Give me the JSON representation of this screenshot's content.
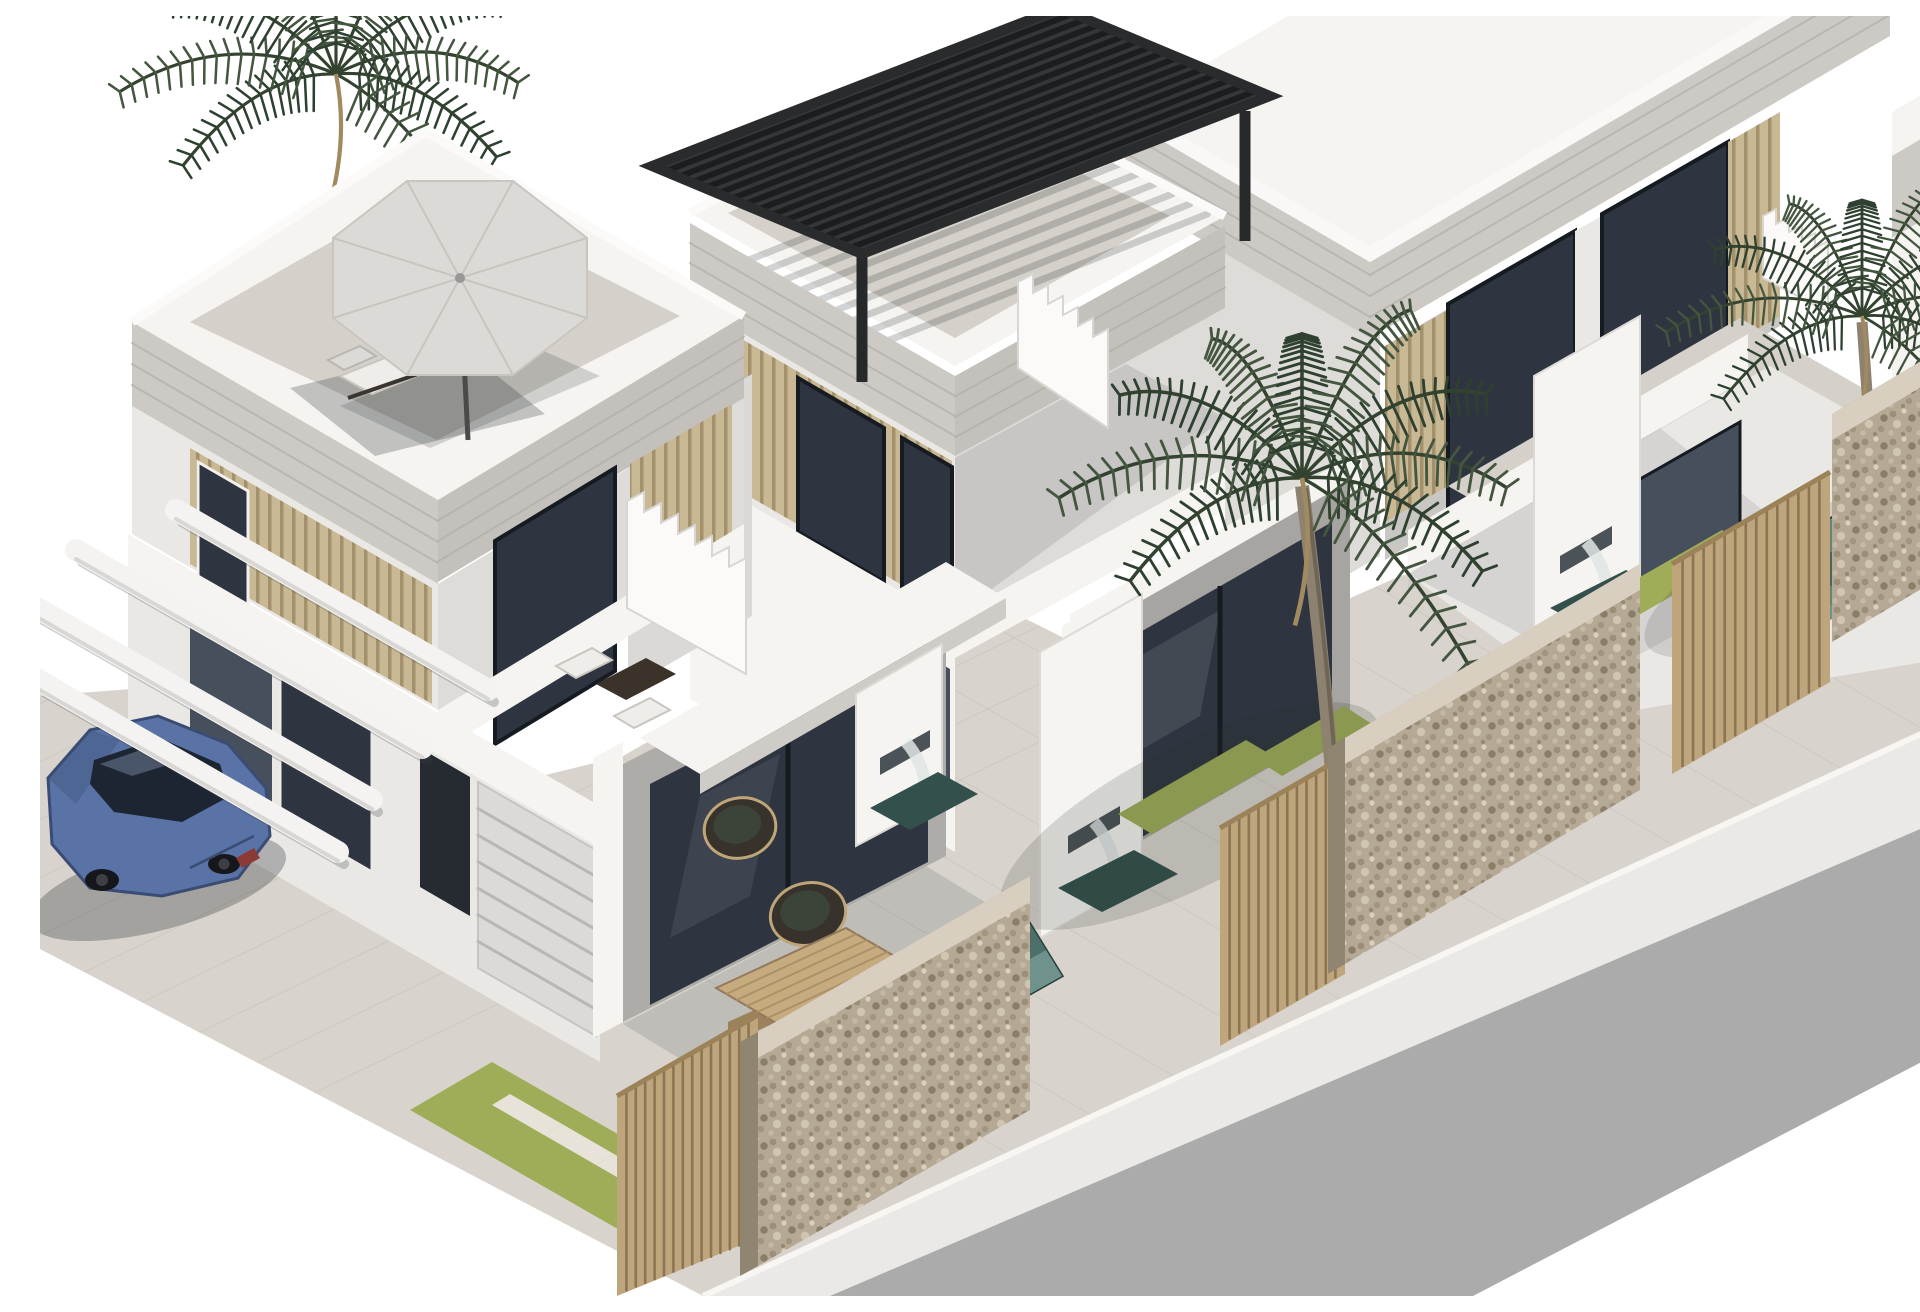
{
  "meta": {
    "title": "3D exterior render - modern white villas with pools",
    "description": "Architectural visualization, aerial three-quarter view: three attached two-storey white villas with roof terraces, private teal mosaic pools, natural stone walls, wood-slat gates, palm trees, a steel-blue sedan parked under a white carport, and an empty gray street along the lower right edge on a plain white background."
  },
  "palette": {
    "bg": "#ffffff",
    "wall-light": "#f5f4f1",
    "wall-mid": "#eae8e5",
    "wall-shade": "#dedcd8",
    "wall-dark": "#c9c7c3",
    "stone-band": "#cdcac5",
    "stone-line": "#b2afa9",
    "slat": "#c8b994",
    "slat-line": "#a3916b",
    "wood": "#bfa57c",
    "wood-dark": "#86704f",
    "glass-dark": "#2e3540",
    "glass-mid": "#46505d",
    "glass-light": "#5f6a7a",
    "frame": "#161b22",
    "tile": "#d5d1ca",
    "tile-line": "#c5c1b8",
    "patio": "#d8d4cd",
    "grass": "#9fad58",
    "paver": "#e7e3d9",
    "pool-dark": "#33504d",
    "pool-mid": "#4d6f6b",
    "pool-light": "#6f928d",
    "stonewall": "#b5a996",
    "stonewall-dark": "#8f8570",
    "stonewall-light": "#d8cfc0",
    "road": "#ababab",
    "curb": "#ebe9e5",
    "pergola": "#2a2b2d",
    "palm-dark": "#2e4030",
    "palm-mid": "#44563f",
    "trunk": "#8d8170",
    "car-body": "#5a73a6",
    "car-dark": "#3a4c73",
    "car-glass": "#1d2532",
    "umbrella": "#dcdad7",
    "umbrella-shade": "#c9c6c2",
    "cushion": "#efede9",
    "rattan": "#37322b",
    "wood-table": "#c6ab7e",
    "water": "#dfe5e4"
  },
  "scene": {
    "setting": "Row of three modern two-storey white villas with roof terraces, seen from above at a three-quarter angle",
    "sky": "plain white background",
    "street": {
      "position": "bottom-right diagonal",
      "surface": "plain gray asphalt",
      "edge": "white concrete sidewalk band"
    },
    "villas": [
      {
        "name": "villa-left",
        "roof": "terrace with gray parasol and two sun loungers",
        "extras": [
          "white-beam carport",
          "garage door",
          "glazed patio doors",
          "rattan lounge chairs and wooden coffee table",
          "balcony with white chairs"
        ]
      },
      {
        "name": "villa-middle",
        "roof": "terrace with black slatted pergola",
        "extras": [
          "exterior white staircase",
          "glazed facade",
          "tall palm tree in yard"
        ]
      },
      {
        "name": "villa-right",
        "roof": "terrace cropped by image top",
        "extras": [
          "recessed balcony with dark glass sliders",
          "wood-slat cladding",
          "palm tree in yard"
        ]
      }
    ],
    "front-yards": {
      "pools": 3,
      "pool-finish": "green-teal mosaic tile with stepped entry",
      "fences": [
        "speckled natural stone walls",
        "vertical wood-slat gates"
      ],
      "lawn": "artificial grass strips with light pavers",
      "water-features": "white dividing walls with wall-mounted waterfalls"
    },
    "vehicle": {
      "type": "sedan car",
      "color-name": "steel blue",
      "position": "parked under left carport"
    },
    "vegetation": {
      "palm-trees": 3
    }
  }
}
